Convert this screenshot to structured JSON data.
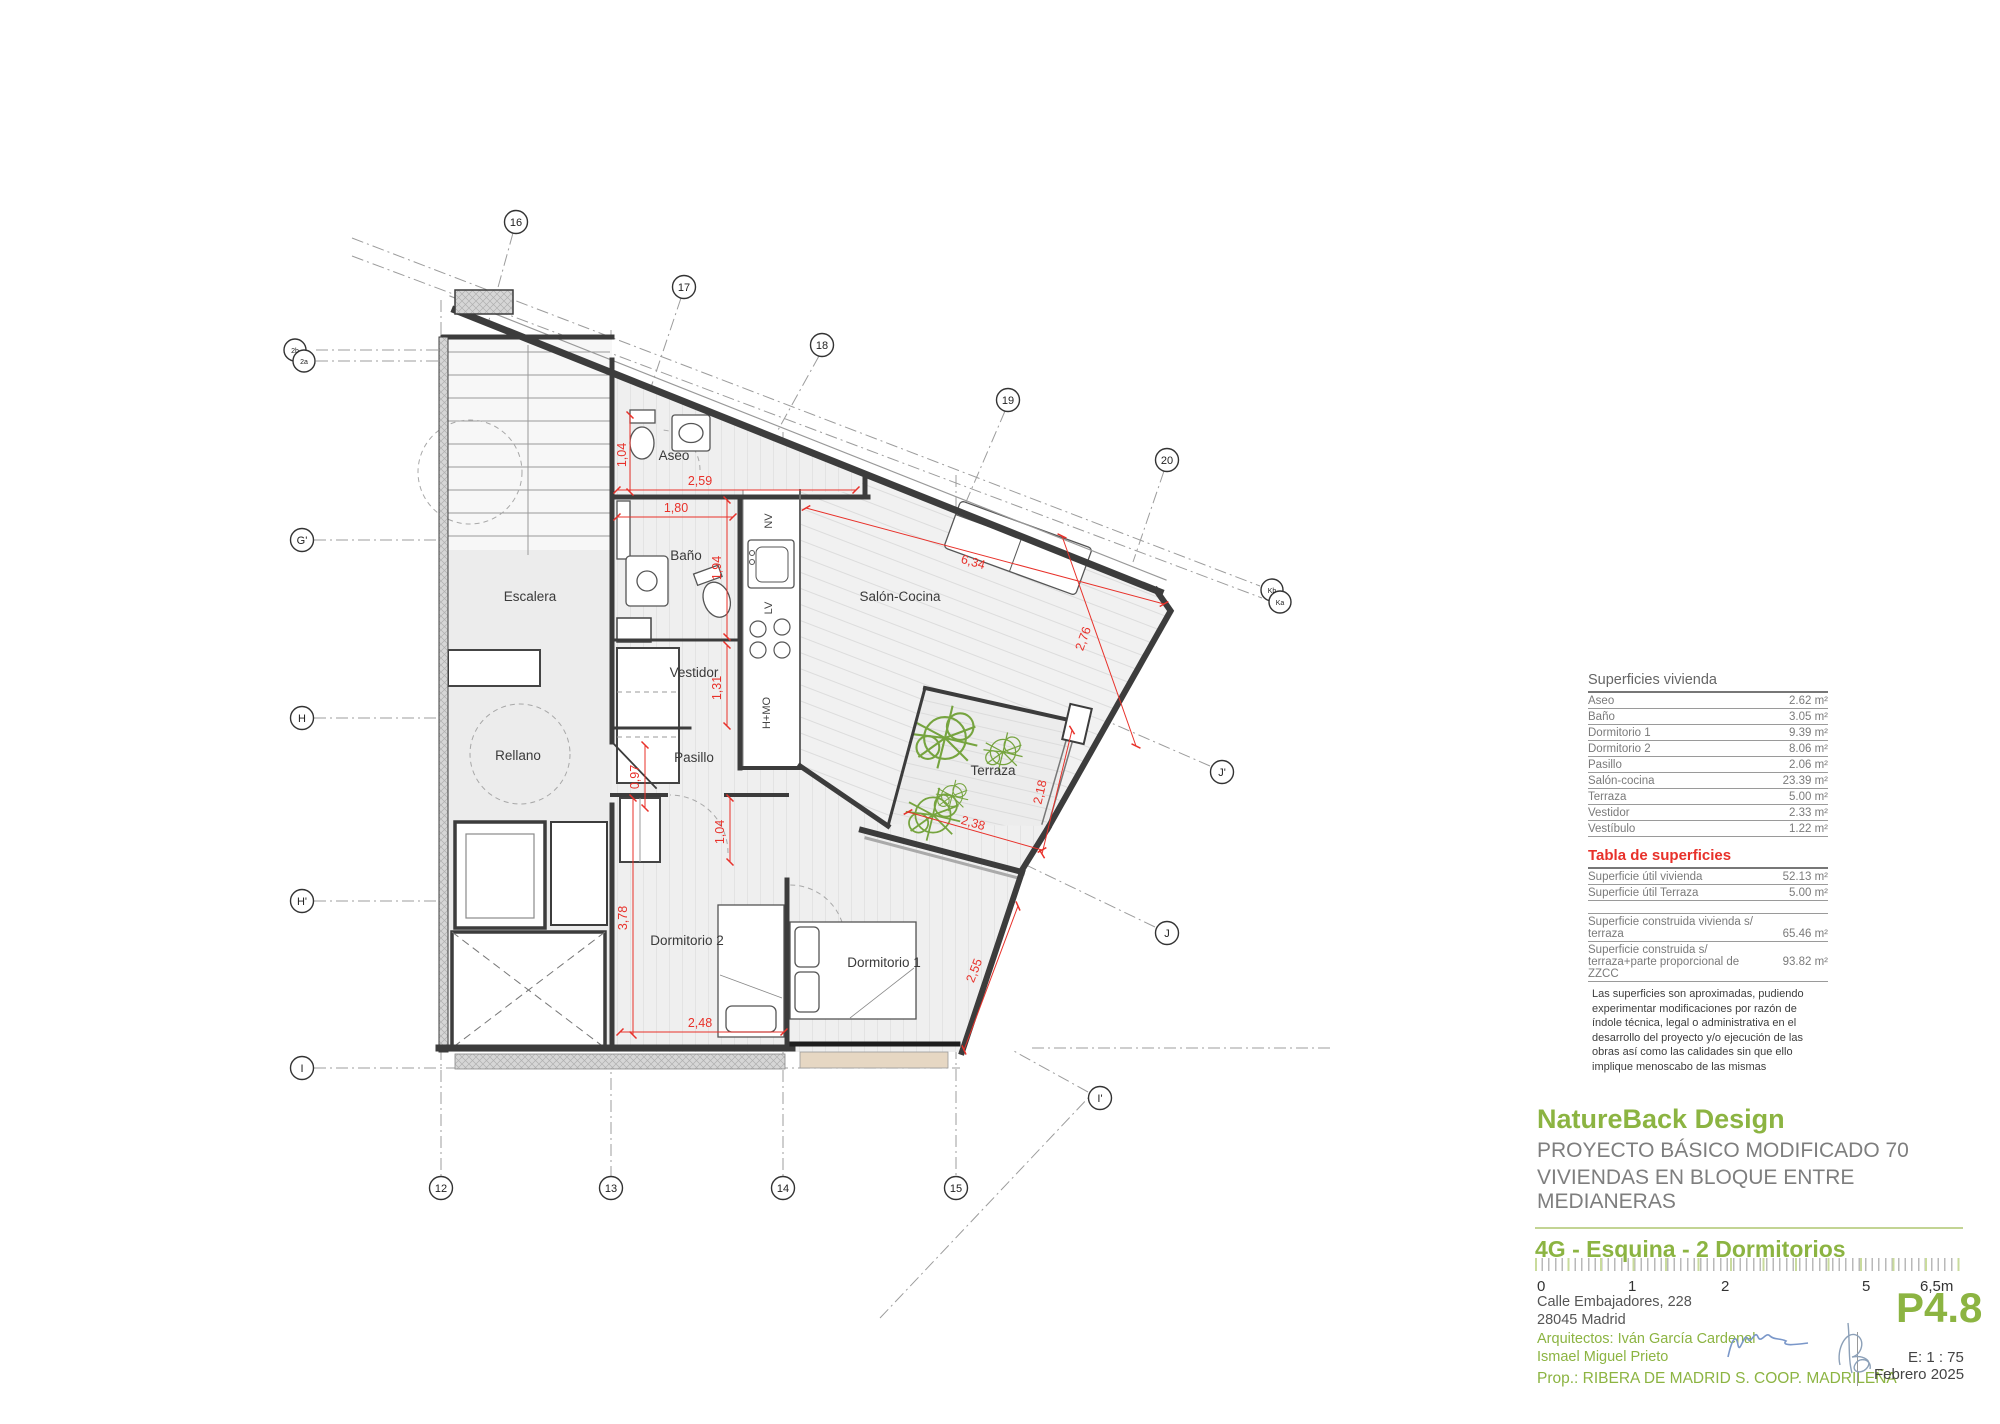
{
  "colors": {
    "accent_green": "#8cb442",
    "dimension_red": "#e8312a",
    "wall_gray": "#3c3c3c",
    "signature_blue": "#7a97c9"
  },
  "plan": {
    "rooms": {
      "escalera": "Escalera",
      "rellano": "Rellano",
      "aseo": "Aseo",
      "bano": "Baño",
      "vestidor": "Vestidor",
      "pasillo": "Pasillo",
      "salon": "Salón-Cocina",
      "terraza": "Terraza",
      "dorm1": "Dormitorio 1",
      "dorm2": "Dormitorio 2"
    },
    "appliances": {
      "nv": "NV",
      "lv": "LV",
      "hmo": "H+MO"
    },
    "dims": {
      "aseo_h": "1,04",
      "aseo_w": "2,59",
      "bano_w": "1,80",
      "bano_h": "1,94",
      "vestidor_h": "1,31",
      "pasillo_w": "0,97",
      "salon_l": "6,34",
      "salon_w": "2,76",
      "terraza_h": "2,18",
      "terraza_w": "2,38",
      "dorm2_door": "1,04",
      "dorm2_h": "3,78",
      "dorm2_w": "2,48",
      "dorm1_w": "2,55"
    },
    "grid": {
      "top": [
        "16",
        "17",
        "18",
        "19",
        "20"
      ],
      "bottom": [
        "12",
        "13",
        "14",
        "15"
      ],
      "left": [
        "G'",
        "H",
        "H'",
        "I"
      ],
      "right": [
        "J'",
        "J",
        "I'"
      ],
      "pairs": {
        "left_a": "2b",
        "left_b": "2a",
        "right_a": "Kb",
        "right_b": "Ka"
      }
    }
  },
  "surfaces": {
    "title": "Superficies vivienda",
    "rows": [
      {
        "label": "Aseo",
        "value": "2.62 m²"
      },
      {
        "label": "Baño",
        "value": "3.05 m²"
      },
      {
        "label": "Dormitorio 1",
        "value": "9.39 m²"
      },
      {
        "label": "Dormitorio 2",
        "value": "8.06 m²"
      },
      {
        "label": "Pasillo",
        "value": "2.06 m²"
      },
      {
        "label": "Salón-cocina",
        "value": "23.39 m²"
      },
      {
        "label": "Terraza",
        "value": "5.00 m²"
      },
      {
        "label": "Vestidor",
        "value": "2.33 m²"
      },
      {
        "label": "Vestíbulo",
        "value": "1.22 m²"
      }
    ]
  },
  "totals": {
    "title": "Tabla de superficies",
    "rows": [
      {
        "label": "Superficie útil vivienda",
        "value": "52.13 m²"
      },
      {
        "label": "Superficie útil Terraza",
        "value": "5.00 m²"
      },
      {
        "label": "Superficie construida vivienda s/ terraza",
        "value": "65.46 m²"
      },
      {
        "label": "Superficie construida s/ terraza+parte proporcional de ZZCC",
        "value": "93.82 m²"
      }
    ]
  },
  "disclaimer": "Las superficies son aproximadas, pudiendo experimentar modificaciones por razón de índole técnica, legal o administrativa en el desarrollo del proyecto y/o ejecución de las obras así como las calidades sin que ello implique menoscabo de las mismas",
  "title_block": {
    "brand": "NatureBack Design",
    "line1": "PROYECTO BÁSICO MODIFICADO 70",
    "line2": "VIVIENDAS EN BLOQUE ENTRE MEDIANERAS"
  },
  "sheet": {
    "unit_title": "4G - Esquina - 2 Dormitorios",
    "scale_ticks": [
      "0",
      "1",
      "2",
      "5",
      "6,5m"
    ],
    "address1": "Calle Embajadores, 228",
    "address2": "28045 Madrid",
    "architects1": "Arquitectos: Iván García Cardenal",
    "architects2": "Ismael Miguel Prieto",
    "prop": "Prop.: RIBERA DE MADRID S. COOP. MADRILEÑA",
    "sheet_no": "P4.8",
    "scale": "E: 1 : 75",
    "date": "Febrero 2025"
  }
}
